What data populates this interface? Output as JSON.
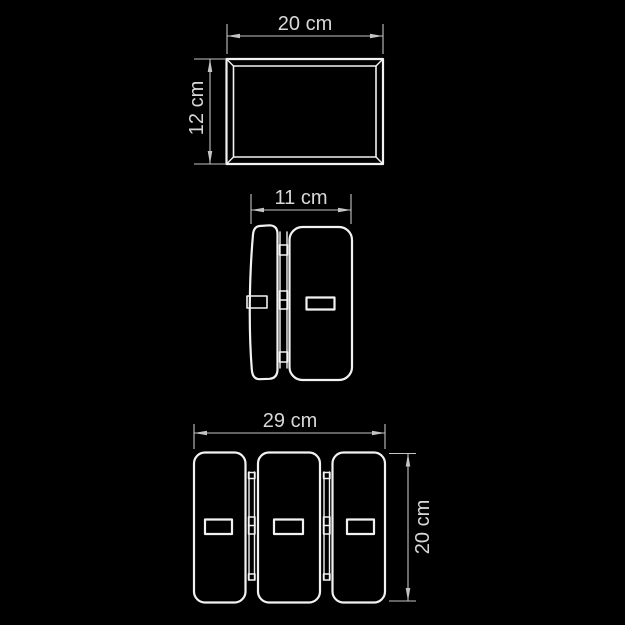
{
  "drawing": {
    "kind": "technical-dimension-drawing",
    "views": [
      "top-view",
      "side-view",
      "front-view"
    ]
  },
  "dimensions": {
    "top_width": "20 cm",
    "top_depth": "12 cm",
    "side_depth": "11 cm",
    "front_width": "29 cm",
    "front_height": "20 cm"
  },
  "colors": {
    "background": "#000000",
    "outline": "#f2f2f2",
    "dim": "#c4c4c4",
    "text": "#d8d8d8"
  }
}
